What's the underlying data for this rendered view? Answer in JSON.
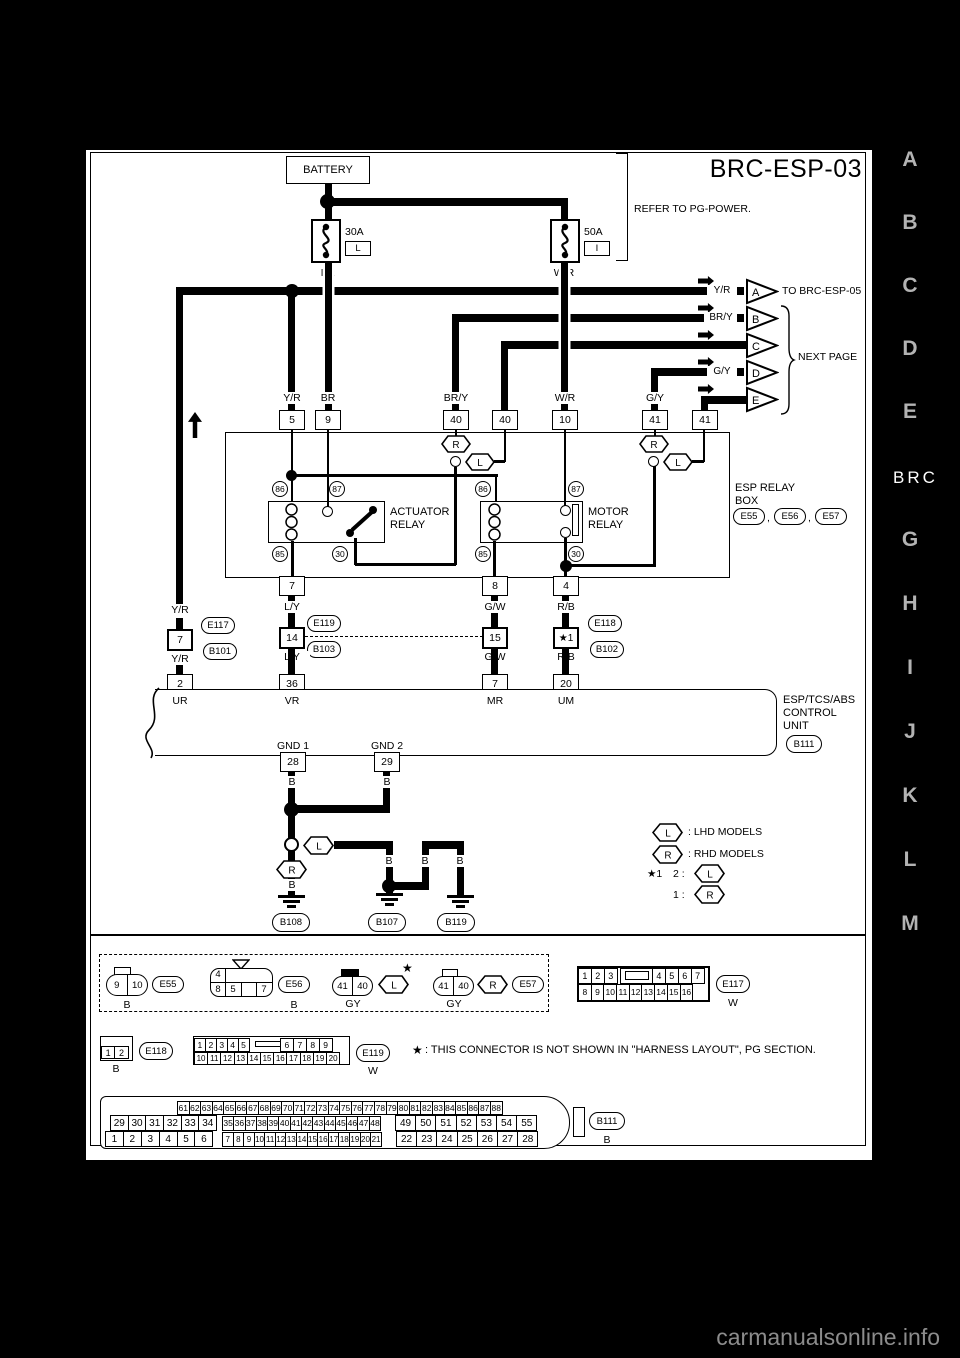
{
  "page": {
    "title": "BRC-ESP-03",
    "footer": "carmanualsonline.info"
  },
  "sidebar": {
    "letters_top": [
      "A",
      "B",
      "C",
      "D",
      "E"
    ],
    "section": "BRC",
    "letters_bottom": [
      "G",
      "H",
      "I",
      "J",
      "K",
      "L",
      "M"
    ]
  },
  "power": {
    "battery": "BATTERY",
    "refer": "REFER TO PG-POWER.",
    "fuse1_amp": "30A",
    "fuse1_slot": "L",
    "fuse1_wire": "BR",
    "fuse2_amp": "50A",
    "fuse2_slot": "I",
    "fuse2_wire": "W/R"
  },
  "offpage": {
    "letters": [
      "A",
      "B",
      "C",
      "D",
      "E"
    ],
    "a_wire": "Y/R",
    "a_dest": "TO BRC-ESP-05",
    "b_wire": "BR/Y",
    "d_wire": "G/Y",
    "next_page": "NEXT PAGE"
  },
  "relay_box": {
    "pins_top": [
      "5",
      "9",
      "40",
      "40",
      "10",
      "41",
      "41"
    ],
    "wires_top": [
      "Y/R",
      "BR",
      "BR/Y",
      "W/R",
      "G/Y"
    ],
    "pin86": "86",
    "pin87": "87",
    "pin85": "85",
    "pin30": "30",
    "actuator1": "ACTUATOR",
    "actuator2": "RELAY",
    "motor1": "MOTOR",
    "motor2": "RELAY",
    "name1": "ESP RELAY",
    "name2": "BOX",
    "conn1": "E55",
    "conn2": "E56",
    "conn3": "E57",
    "comma": ",",
    "pins_bottom": [
      "7",
      "8",
      "4"
    ]
  },
  "symbols": {
    "lhd": "L",
    "rhd": "R",
    "star": "★"
  },
  "harness": {
    "yr": {
      "wire": "Y/R",
      "pin": "7",
      "conn_a": "E117",
      "conn_b": "B101",
      "cu_pin": "2",
      "cu_label": "UR"
    },
    "ly": {
      "wire": "L/Y",
      "pin": "14",
      "conn_a": "E119",
      "conn_b": "B103",
      "cu_pin": "36",
      "cu_label": "VR"
    },
    "gw": {
      "wire": "G/W",
      "pin": "15",
      "cu_pin": "7",
      "cu_label": "MR"
    },
    "rb": {
      "wire": "R/B",
      "pin": "★1",
      "conn_a": "E118",
      "conn_b": "B102",
      "cu_pin": "20",
      "cu_label": "UM"
    }
  },
  "control_unit": {
    "name1": "ESP/TCS/ABS",
    "name2": "CONTROL",
    "name3": "UNIT",
    "conn": "B111",
    "gnd1": "GND 1",
    "gnd2": "GND 2",
    "pin28": "28",
    "pin29": "29"
  },
  "grounds": {
    "b": "B",
    "g108": "B108",
    "g107": "B107",
    "g119": "B119"
  },
  "legend": {
    "lhd": ": LHD MODELS",
    "rhd": ": RHD MODELS",
    "star1": "★1",
    "opt2": "2 :",
    "opt1": "1 :"
  },
  "row1": {
    "c1_pins": [
      "9",
      "10"
    ],
    "c1_label": "E55",
    "c1_color": "B",
    "c2_top": "4",
    "c2_pins": [
      "8",
      "5",
      "",
      "7"
    ],
    "c2_label": "E56",
    "c2_color": "B",
    "c3_pins": [
      "41",
      "40"
    ],
    "c3_color": "GY",
    "c4_pins": [
      "41",
      "40"
    ],
    "c4_color": "GY",
    "c4_label": "E57",
    "e117_r1a": [
      "1",
      "2",
      "3"
    ],
    "e117_r1b": [
      "4",
      "5",
      "6",
      "7"
    ],
    "e117_r2": [
      "8",
      "9",
      "10",
      "11",
      "12",
      "13",
      "14",
      "15",
      "16"
    ],
    "e117_label": "E117",
    "e117_color": "W"
  },
  "row2": {
    "e118_pins": [
      "1",
      "2"
    ],
    "e118_label": "E118",
    "e118_color": "B",
    "e119_r1a": [
      "1",
      "2",
      "3",
      "4",
      "5"
    ],
    "e119_r1b": [
      "6",
      "7",
      "8",
      "9"
    ],
    "e119_r2": [
      "10",
      "11",
      "12",
      "13",
      "14",
      "15",
      "16",
      "17",
      "18",
      "19",
      "20"
    ],
    "e119_label": "E119",
    "e119_color": "W",
    "note": ": THIS CONNECTOR IS NOT SHOWN IN \"HARNESS LAYOUT\", PG SECTION."
  },
  "b111": {
    "row_top": [
      "61",
      "62",
      "63",
      "64",
      "65",
      "66",
      "67",
      "68",
      "69",
      "70",
      "71",
      "72",
      "73",
      "74",
      "75",
      "76",
      "77",
      "78",
      "79",
      "80",
      "81",
      "82",
      "83",
      "84",
      "85",
      "86",
      "87",
      "88"
    ],
    "row_mid_l": [
      "29",
      "30",
      "31",
      "32",
      "33",
      "34"
    ],
    "row_mid_s": [
      "35",
      "36",
      "37",
      "38",
      "39",
      "40",
      "41",
      "42",
      "43",
      "44",
      "45",
      "46",
      "47",
      "48"
    ],
    "row_mid_r": [
      "49",
      "50",
      "51",
      "52",
      "53",
      "54",
      "55"
    ],
    "row_bot_l": [
      "1",
      "2",
      "3",
      "4",
      "5",
      "6"
    ],
    "row_bot_s": [
      "7",
      "8",
      "9",
      "10",
      "11",
      "12",
      "13",
      "14",
      "15",
      "16",
      "17",
      "18",
      "19",
      "20",
      "21"
    ],
    "row_bot_r": [
      "22",
      "23",
      "24",
      "25",
      "26",
      "27",
      "28"
    ],
    "label": "B111",
    "color": "B"
  }
}
